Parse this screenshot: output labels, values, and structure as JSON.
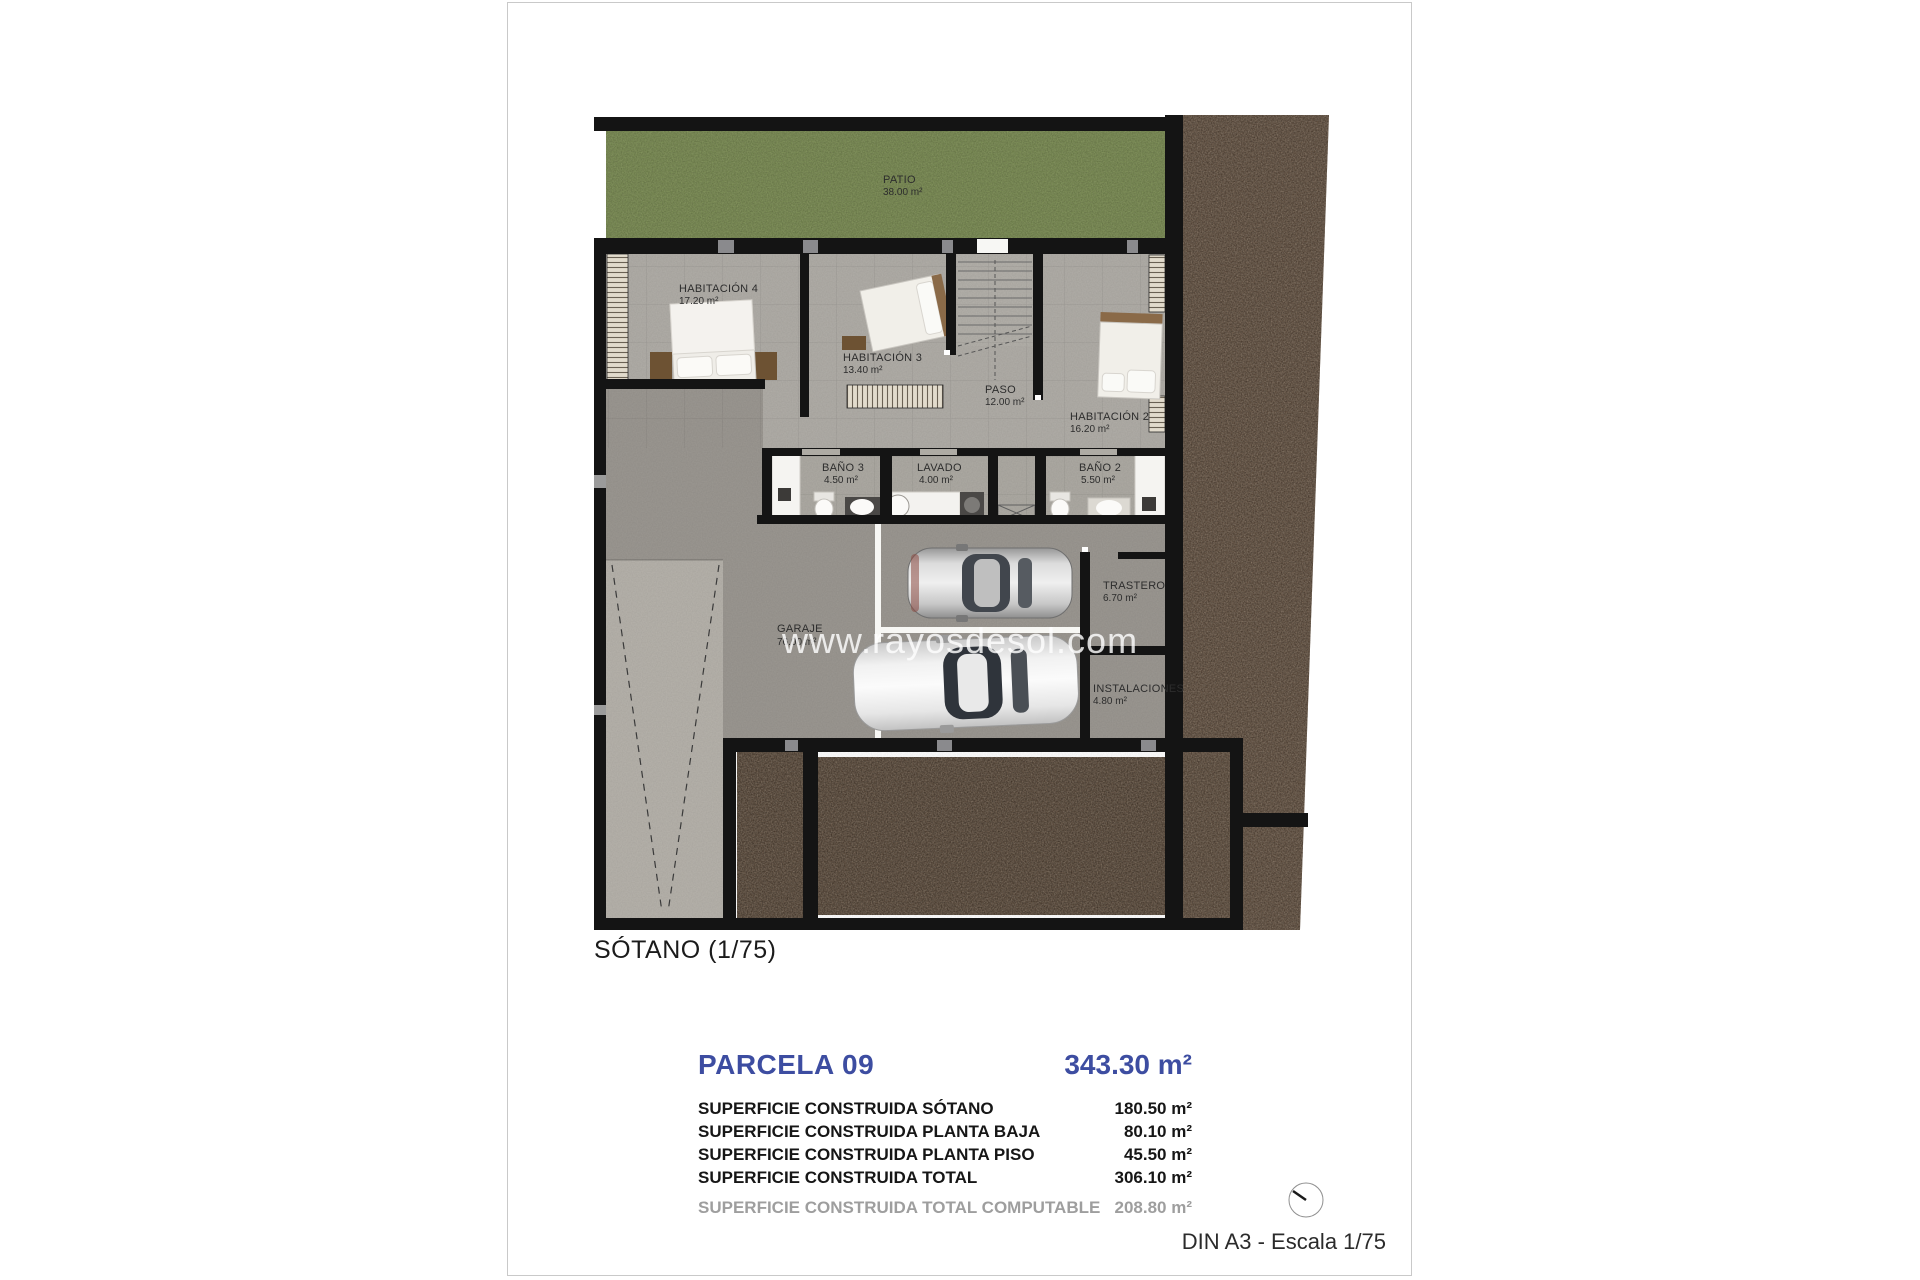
{
  "plan": {
    "title": "SÓTANO (1/75)",
    "watermark": "www.rayosdesol.com",
    "rooms": [
      {
        "id": "patio",
        "name": "PATIO",
        "area": "38.00 m²"
      },
      {
        "id": "habitacion-4",
        "name": "HABITACIÓN 4",
        "area": "17.20 m²"
      },
      {
        "id": "habitacion-3",
        "name": "HABITACIÓN 3",
        "area": "13.40 m²"
      },
      {
        "id": "paso",
        "name": "PASO",
        "area": "12.00 m²"
      },
      {
        "id": "habitacion-2",
        "name": "HABITACIÓN 2",
        "area": "16.20 m²"
      },
      {
        "id": "bano-3",
        "name": "BAÑO 3",
        "area": "4.50 m²"
      },
      {
        "id": "lavado",
        "name": "LAVADO",
        "area": "4.00 m²"
      },
      {
        "id": "bano-2",
        "name": "BAÑO 2",
        "area": "5.50 m²"
      },
      {
        "id": "garaje",
        "name": "GARAJE",
        "area": "76.00 m²"
      },
      {
        "id": "trastero",
        "name": "TRASTERO",
        "area": "6.70 m²"
      },
      {
        "id": "instalaciones",
        "name": "INSTALACIONES",
        "area": "4.80 m²"
      }
    ]
  },
  "summary": {
    "parcel_label": "PARCELA 09",
    "parcel_area": "343.30 m²",
    "rows": [
      {
        "label": "SUPERFICIE CONSTRUIDA SÓTANO",
        "value": "180.50 m²"
      },
      {
        "label": "SUPERFICIE CONSTRUIDA PLANTA BAJA",
        "value": "80.10 m²"
      },
      {
        "label": "SUPERFICIE CONSTRUIDA PLANTA PISO",
        "value": "45.50 m²"
      },
      {
        "label": "SUPERFICIE CONSTRUIDA TOTAL",
        "value": "306.10 m²"
      },
      {
        "label": "SUPERFICIE CONSTRUIDA TOTAL COMPUTABLE",
        "value": "208.80 m²"
      }
    ]
  },
  "footer": {
    "scale_note": "DIN A3 - Escala 1/75"
  },
  "colors": {
    "accent_blue": "#3d4da1",
    "muted_gray": "#9e9e9e",
    "patio_green": "#7d9154",
    "terrain_brown": "#5e4938",
    "wall_black": "#141414"
  }
}
